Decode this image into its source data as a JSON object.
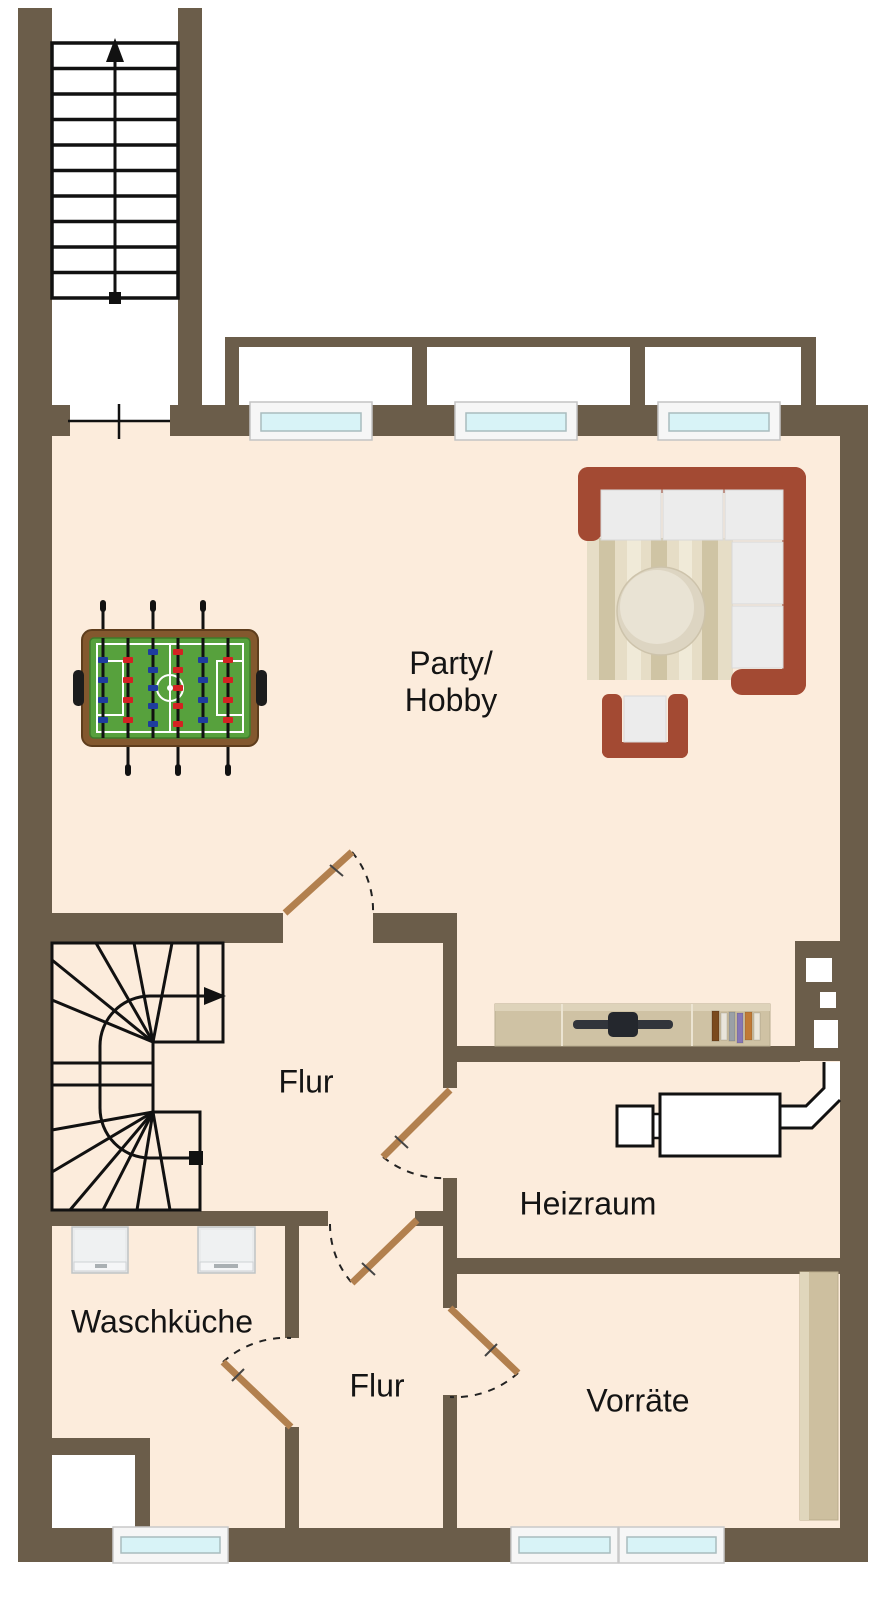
{
  "rooms": {
    "party_hobby": {
      "line1": "Party/",
      "line2": "Hobby"
    },
    "flur_upper": {
      "label": "Flur"
    },
    "heizraum": {
      "label": "Heizraum"
    },
    "waschkueche": {
      "label": "Waschküche"
    },
    "flur_lower": {
      "label": "Flur"
    },
    "vorraete": {
      "label": "Vorräte"
    }
  },
  "stairs": {
    "upper_straight": {
      "direction": "up"
    },
    "middle_winder": {
      "direction": "up-right"
    }
  },
  "doors": [
    "party-hobby-door",
    "heizraum-door",
    "flur-connecting-door",
    "waschkueche-door",
    "vorraete-door",
    "stairwell-passage"
  ],
  "windows": {
    "top_wall": 3,
    "bottom_wall": 3,
    "light_wells": 3
  },
  "furniture": [
    "foosball-table",
    "corner-sofa",
    "striped-rug",
    "round-coffee-table",
    "armchair",
    "sideboard",
    "flatscreen-tv",
    "books",
    "boiler",
    "flue-pipe",
    "chimney",
    "washing-machine",
    "washing-machine",
    "storage-shelf",
    "utility-niche"
  ],
  "colors": {
    "wall": "#6b5d4a",
    "floor": "#fcecdc",
    "outside": "#ffffff",
    "stair_lines": "#111111",
    "door_leaf": "#b2804e",
    "window_glass": "#d8f3f7",
    "window_frame": "#f6f6f6",
    "sofa_frame": "#a34a33",
    "sofa_cushion": "#ececec",
    "rug_beige": "#e6ddc6",
    "foosball_field": "#57a13d",
    "team_blue": "#1e3d9e",
    "team_red": "#d32222",
    "sideboard_wood": "#cfc2a4"
  }
}
